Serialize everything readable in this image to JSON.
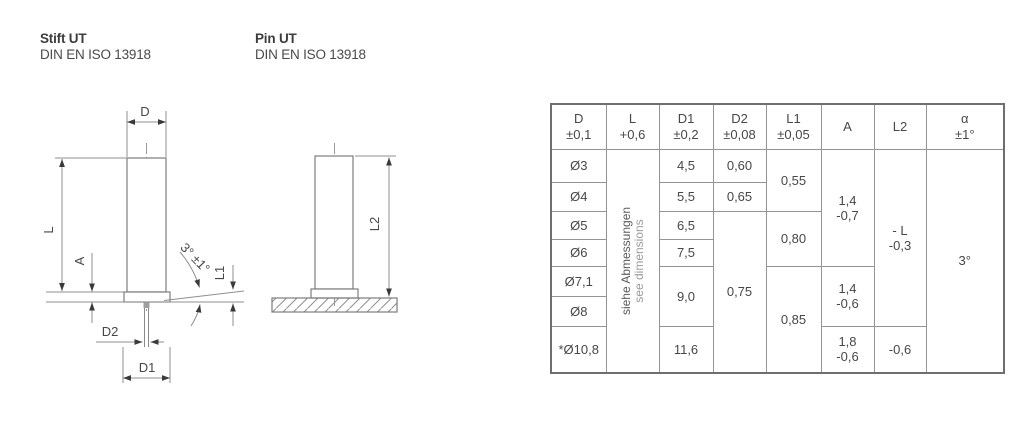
{
  "colors": {
    "background": "#ffffff",
    "drawing_line": "#8f8f8f",
    "part_outline": "#7d7d7d",
    "text": "#474545",
    "muted_text": "#9c9c9c",
    "table_border": "#949494"
  },
  "title_left": {
    "name": "Stift UT",
    "standard": "DIN EN ISO 13918"
  },
  "title_right": {
    "name": "Pin UT",
    "standard": "DIN EN ISO 13918"
  },
  "drawing_stift": {
    "labels": {
      "d": "D",
      "l": "L",
      "a": "A",
      "d2": "D2",
      "d1": "D1",
      "l1": "L1",
      "angle": "3° ±1°"
    }
  },
  "drawing_pin": {
    "labels": {
      "l2": "L2"
    }
  },
  "table": {
    "headers": [
      {
        "symbol": "D",
        "tolerance": "±0,1"
      },
      {
        "symbol": "L",
        "tolerance": "+0,6"
      },
      {
        "symbol": "D1",
        "tolerance": "±0,2"
      },
      {
        "symbol": "D2",
        "tolerance": "±0,08"
      },
      {
        "symbol": "L1",
        "tolerance": "±0,05"
      },
      {
        "symbol": "A",
        "tolerance": ""
      },
      {
        "symbol": "L2",
        "tolerance": ""
      },
      {
        "symbol": "α",
        "tolerance": "±1°"
      }
    ],
    "l_note": {
      "de": "siehe Abmessungen",
      "en": "see dimensions"
    },
    "col_d": [
      "Ø3",
      "Ø4",
      "Ø5",
      "Ø6",
      "Ø7,1",
      "Ø8",
      "*Ø10,8"
    ],
    "col_d1": [
      "4,5",
      "5,5",
      "6,5",
      "7,5",
      "9,0",
      "11,6"
    ],
    "col_d2": [
      "0,60",
      "0,65",
      "0,75"
    ],
    "col_l1": [
      "0,55",
      "0,80",
      "0,85"
    ],
    "col_a": [
      {
        "line1": "1,4",
        "line2": "-0,7"
      },
      {
        "line1": "1,4",
        "line2": "-0,6"
      },
      {
        "line1": "1,8",
        "line2": "-0,6"
      }
    ],
    "col_l2": [
      {
        "line1": "- L",
        "line2": "-0,3"
      },
      {
        "line1": "-0,6"
      }
    ],
    "col_alpha": "3°"
  }
}
